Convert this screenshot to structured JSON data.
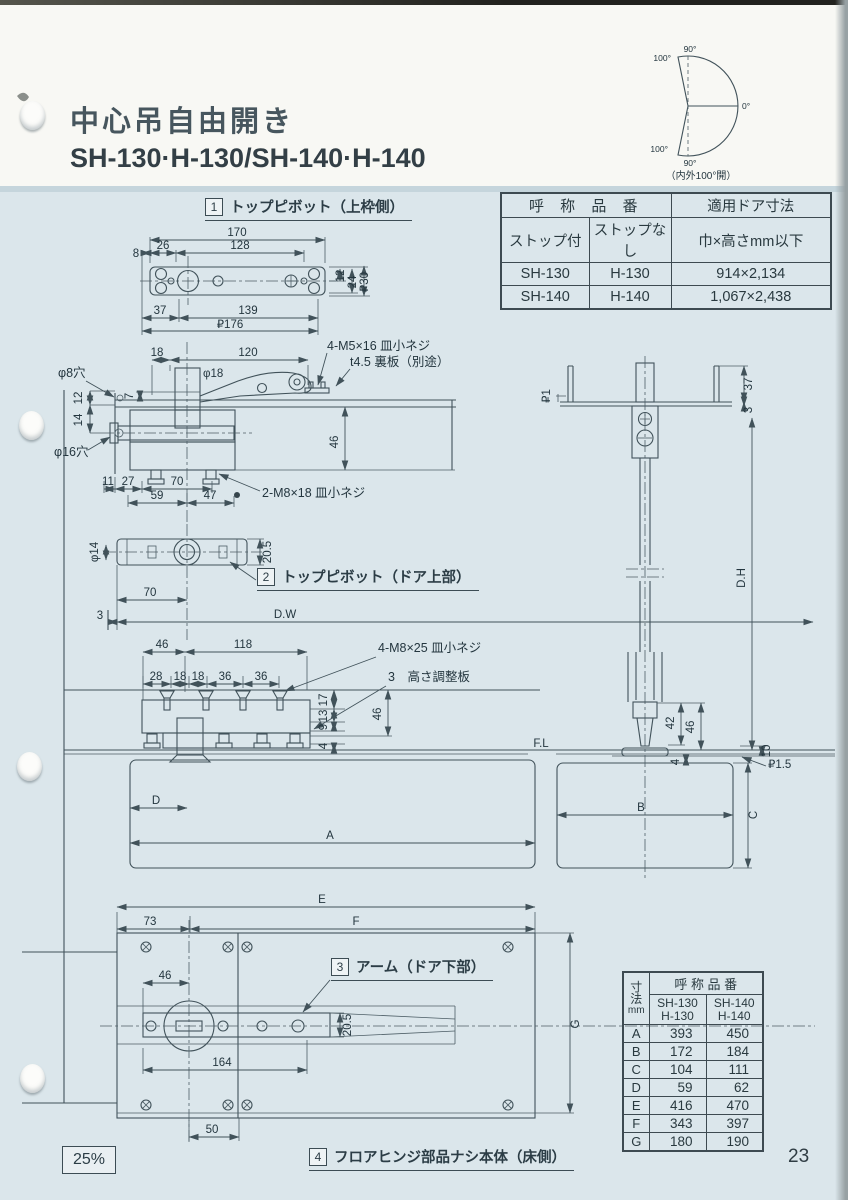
{
  "page": {
    "title": "中心吊自由開き",
    "subtitle": "SH-130·H-130/SH-140·H-140",
    "page_number": "23",
    "scale": "25%"
  },
  "fan": {
    "caption": "（内外100°開）",
    "top100": "100°",
    "top90": "90°",
    "right0": "0°",
    "bot100": "100°",
    "bot90": "90°"
  },
  "model_table": {
    "h_name": "呼 称 品 番",
    "h_door": "適用ドア寸法",
    "h_stop": "ストップ付",
    "h_nostop": "ストップなし",
    "h_size": "巾×高さmm以下",
    "rows": [
      {
        "stop": "SH-130",
        "nostop": "H-130",
        "size": "914×2,134"
      },
      {
        "stop": "SH-140",
        "nostop": "H-140",
        "size": "1,067×2,438"
      }
    ]
  },
  "sections": {
    "s1": {
      "no": "1",
      "label": "トップピボット（上枠側）"
    },
    "s2": {
      "no": "2",
      "label": "トップピボット（ドア上部）"
    },
    "s3": {
      "no": "3",
      "label": "アーム（ドア下部）"
    },
    "s4": {
      "no": "4",
      "label": "フロアヒンジ部品ナシ本体（床側）"
    }
  },
  "d1": {
    "w": "170",
    "s8": "8",
    "s26": "26",
    "s128": "128",
    "h12": "12",
    "h24": "24",
    "h30": "₽30",
    "b37": "37",
    "b139": "139",
    "b176": "₽176"
  },
  "d2": {
    "t18": "18",
    "t120": "120",
    "phi18": "φ18",
    "v7": "7",
    "v12": "12",
    "v14": "14",
    "hole8": "φ8穴",
    "hole16": "φ16穴",
    "h46": "46",
    "b11": "11",
    "b27": "27",
    "b70": "70",
    "b59": "59",
    "b47": "47",
    "m5": "4-M5×16 皿小ネジ",
    "back": "t4.5 裏板（別途）",
    "m8": "2-M8×18 皿小ネジ"
  },
  "d3": {
    "phi14": "φ14",
    "h": "20.5",
    "b70": "70",
    "b3": "3",
    "dw": "D.W"
  },
  "d4": {
    "t46": "46",
    "t118": "118",
    "s28": "28",
    "s18a": "18",
    "s18b": "18",
    "s36a": "36",
    "s36b": "36",
    "m8": "4-M8×25 皿小ネジ",
    "shim": "3　高さ調整板",
    "r17": "17",
    "r13": "13",
    "r9": "9",
    "r4": "4",
    "r46": "46"
  },
  "d5": {
    "p1": "₽1",
    "v37": "37",
    "v3": "3",
    "dh": "D.H",
    "v42": "42",
    "v46": "46",
    "v10": "10",
    "v4": "4",
    "p15": "₽1.5"
  },
  "floor": {
    "fl": "F.L",
    "A": "A",
    "B": "B",
    "C": "C",
    "D": "D"
  },
  "d6": {
    "E": "E",
    "F": "F",
    "G": "G",
    "b73": "73",
    "b46": "46",
    "h205": "20.5",
    "b164": "164",
    "b50": "50"
  },
  "dim_table": {
    "h_name": "呼 称 品 番",
    "dim_chars": [
      "寸",
      "法",
      "mm"
    ],
    "cols": [
      [
        "SH-130",
        "H-130"
      ],
      [
        "SH-140",
        "H-140"
      ]
    ],
    "rows": [
      {
        "k": "A",
        "v1": "393",
        "v2": "450"
      },
      {
        "k": "B",
        "v1": "172",
        "v2": "184"
      },
      {
        "k": "C",
        "v1": "104",
        "v2": "111"
      },
      {
        "k": "D",
        "v1": "59",
        "v2": "62"
      },
      {
        "k": "E",
        "v1": "416",
        "v2": "470"
      },
      {
        "k": "F",
        "v1": "343",
        "v2": "397"
      },
      {
        "k": "G",
        "v1": "180",
        "v2": "190"
      }
    ]
  }
}
